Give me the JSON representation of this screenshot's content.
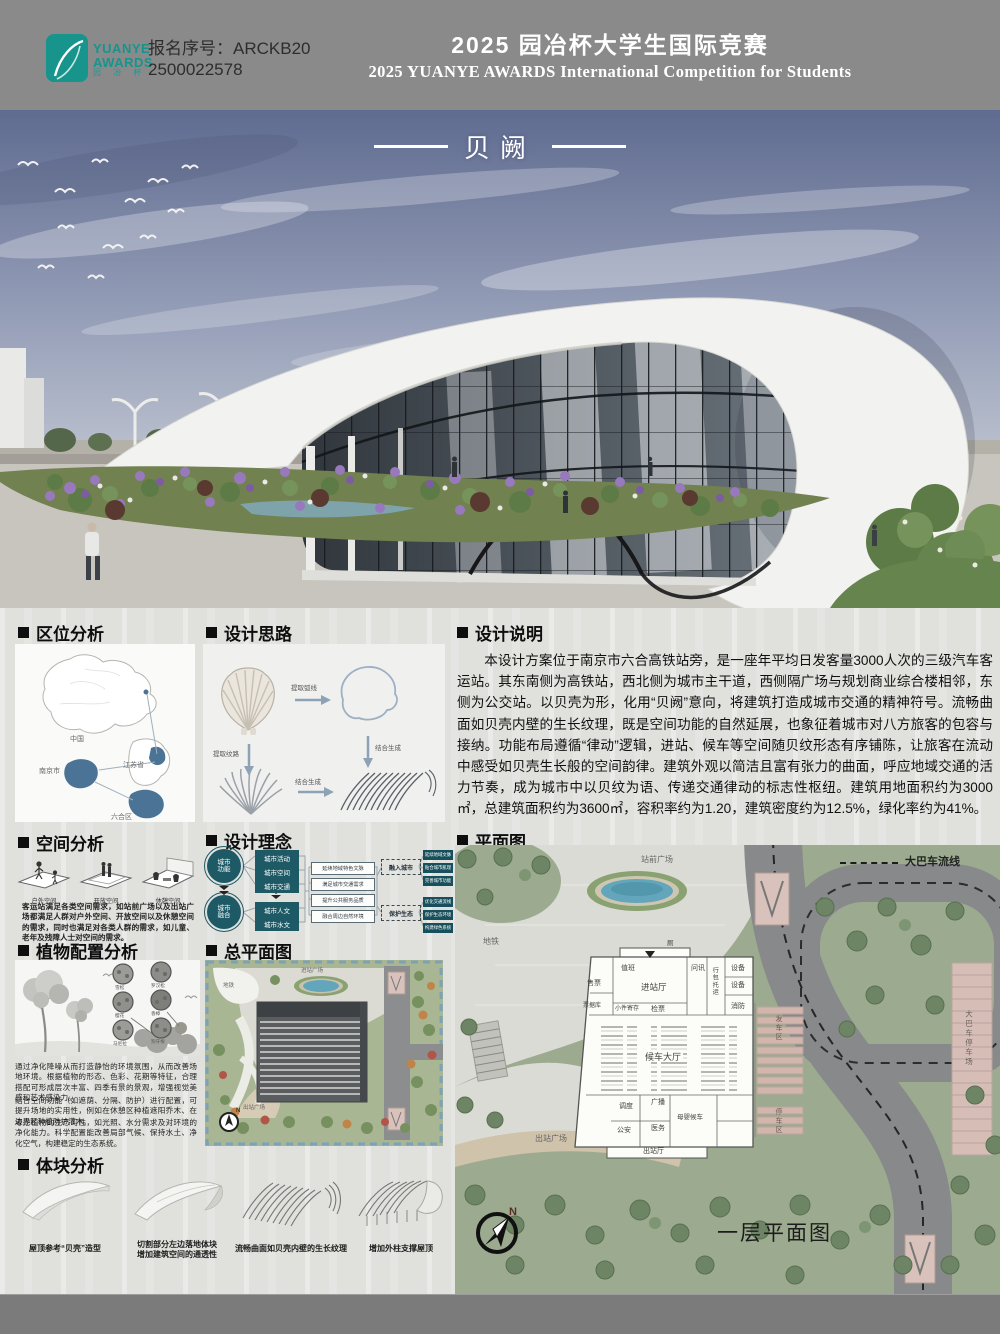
{
  "header": {
    "logo_line1": "YUANYE",
    "logo_line2": "AWARDS",
    "logo_cn": "园 冶 杯",
    "reg_line1": "报名序号：ARCKB20",
    "reg_line2": "2500022578",
    "title_cn": "2025 园冶杯大学生国际竞赛",
    "title_en": "2025 YUANYE AWARDS International Competition for  Students"
  },
  "hero": {
    "title": "贝阙"
  },
  "location": {
    "title": "区位分析",
    "regions": [
      "中国",
      "江苏省",
      "南京市",
      "六合区"
    ]
  },
  "idea": {
    "title": "设计思路",
    "steps": [
      "提取弧线",
      "提取纹路",
      "结合生成",
      "结合生成"
    ]
  },
  "description": {
    "title": "设计说明",
    "body": "本设计方案位于南京市六合高铁站旁，是一座年平均日发客量3000人次的三级汽车客运站。其东南侧为高铁站，西北侧为城市主干道，西侧隔广场与规划商业综合楼相邻，东侧为公交站。以贝壳为形，化用“贝阙”意向，将建筑打造成城市交通的精神符号。流畅曲面如贝壳内壁的生长纹理，既是空间功能的自然延展，也象征着城市对八方旅客的包容与接纳。功能布局遵循“律动”逻辑，进站、候车等空间随贝纹形态有序铺陈，让旅客在流动中感受如贝壳生长般的空间韵律。建筑外观以简洁且富有张力的曲面，呼应地域交通的活力节奏，成为城市中以贝纹为语、传递交通律动的标志性枢纽。建筑用地面积约为3000㎡，总建筑面积约为3600㎡，容积率约为1.20，建筑密度约为12.5%，绿化率约为41%。"
  },
  "space": {
    "title": "空间分析",
    "types": [
      "户外空间",
      "开放空间",
      "休憩空间"
    ],
    "caption": "客运站满足各类空间需求，如站前广场以及出站广场都满足人群对户外空间、开放空间以及休憩空间的需求，同时也满足对各类人群的需求，如儿童、老年及残障人士对空间的需求。"
  },
  "philosophy": {
    "title": "设计理念",
    "circle_top": "城市\n功能",
    "circle_bottom": "城市\n融合",
    "factors": [
      "城市活动",
      "城市空间",
      "城市交通",
      "城市人文",
      "城市水文"
    ],
    "strategies": [
      "延续地域特色文脉",
      "满足城市交通需求",
      "提升公共服务品质",
      "融合周边自然环境"
    ],
    "goals": [
      "融入城市",
      "保护生态"
    ],
    "outcomes": [
      "延续地域文脉",
      "贴合城市肌理",
      "完善城市功能",
      "优化交通流线",
      "保护生态环境",
      "构建绿色系统"
    ]
  },
  "planting": {
    "title": "植物配置分析",
    "plants": [
      "雪松",
      "罗汉松",
      "樱花",
      "香樟",
      "马尼拉",
      "狗牙根"
    ],
    "paragraphs": [
      "通过净化降噪从而打造静怡的环境氛围，从而改善场地环境。根据植物的形态、色彩、花期等特征，合理搭配可形成层次丰富、四季有景的景观，增强视觉美感和艺术感染力。",
      "结合空间功能（如遮荫、分隔、防护）进行配置，可提升场地的实用性，例如在休憩区种植遮阳乔木、在边界区种植防护灌木。",
      "考虑植物的生态习性，如光照、水分需求及对环境的净化能力。科学配置能改善局部气候、保持水土、净化空气，构建稳定的生态系统。"
    ]
  },
  "masterplan": {
    "title": "总平面图",
    "labels": {
      "entry_plaza": "进站广场",
      "metro": "地铁",
      "exit_plaza": "出站广场"
    },
    "north": "N"
  },
  "massing": {
    "title": "体块分析",
    "captions": [
      "屋顶参考“贝壳”造型",
      "切割部分左边落地体块\n增加建筑空间的通透性",
      "流畅曲面如贝壳内壁的生长纹理",
      "增加外柱支撑屋顶"
    ]
  },
  "plan": {
    "title": "平面图",
    "legend": "大巴车流线",
    "caption": "一层平面图",
    "north": "N",
    "labels": {
      "station_plaza": "站前广场",
      "metro": "地铁",
      "exit_plaza": "出站广场",
      "bus_park": "大巴车停车场",
      "depart_zone": "发车区",
      "park_zone": "停车区"
    },
    "rooms": [
      "售票",
      "票据库",
      "值班",
      "进站厅",
      "问讯",
      "行包托运",
      "设备",
      "设备",
      "消防",
      "小件寄存",
      "检票",
      "候车大厅",
      "调度",
      "广播",
      "公安",
      "医务",
      "母婴候车",
      "出站厅",
      "厕"
    ]
  }
}
